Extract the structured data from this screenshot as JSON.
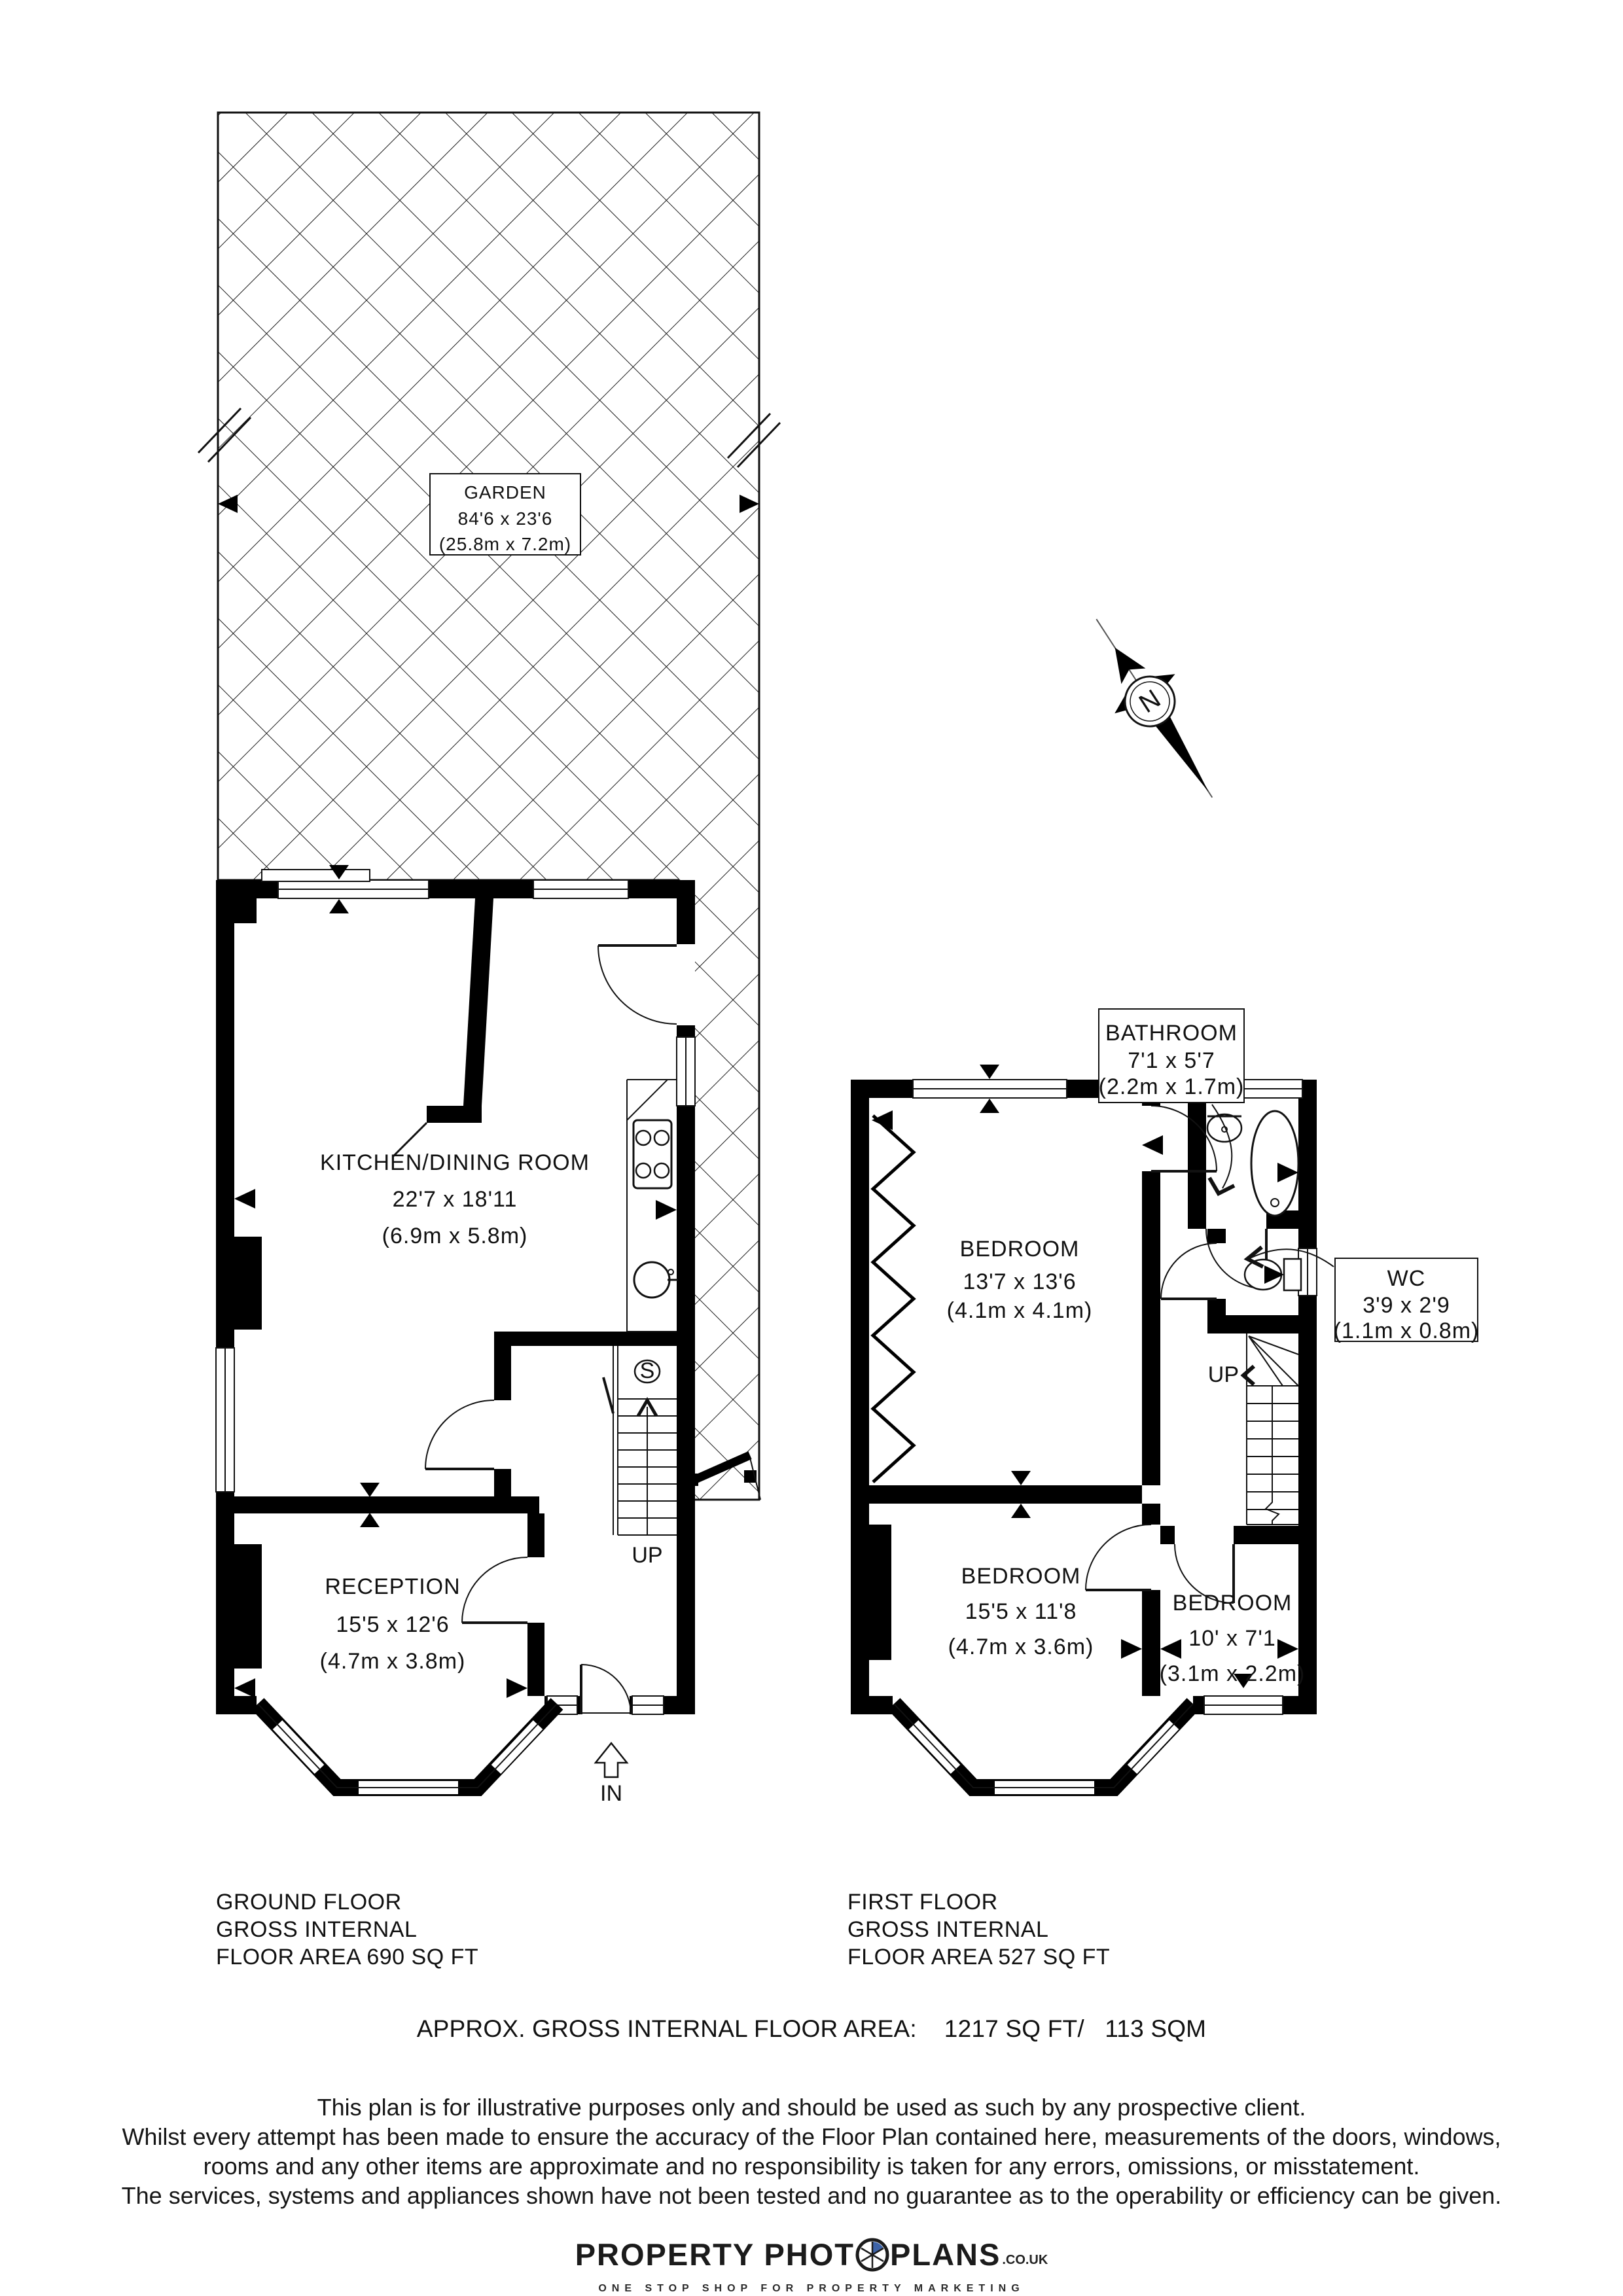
{
  "garden": {
    "name": "GARDEN",
    "size_imperial": "84'6 x 23'6",
    "size_metric": "(25.8m x 7.2m)"
  },
  "ground_floor": {
    "rooms": {
      "kitchen": {
        "name": "KITCHEN/DINING ROOM",
        "size_imperial": "22'7 x 18'11",
        "size_metric": "(6.9m x 5.8m)"
      },
      "reception": {
        "name": "RECEPTION",
        "size_imperial": "15'5 x 12'6",
        "size_metric": "(4.7m x 3.8m)"
      }
    },
    "labels": {
      "up": "UP",
      "in": "IN",
      "storage": "S"
    },
    "summary": {
      "line1": "GROUND FLOOR",
      "line2": "GROSS INTERNAL",
      "line3": "FLOOR AREA 690 SQ FT"
    }
  },
  "first_floor": {
    "rooms": {
      "bathroom": {
        "name": "BATHROOM",
        "size_imperial": "7'1 x 5'7",
        "size_metric": "(2.2m x 1.7m)"
      },
      "wc": {
        "name": "WC",
        "size_imperial": "3'9 x 2'9",
        "size_metric": "(1.1m x 0.8m)"
      },
      "bedroom1": {
        "name": "BEDROOM",
        "size_imperial": "13'7 x 13'6",
        "size_metric": "(4.1m x 4.1m)"
      },
      "bedroom2": {
        "name": "BEDROOM",
        "size_imperial": "15'5 x 11'8",
        "size_metric": "(4.7m x 3.6m)"
      },
      "bedroom3": {
        "name": "BEDROOM",
        "size_imperial": "10' x 7'1",
        "size_metric": "(3.1m x 2.2m)"
      }
    },
    "labels": {
      "up": "UP"
    },
    "summary": {
      "line1": "FIRST FLOOR",
      "line2": "GROSS INTERNAL",
      "line3": "FLOOR AREA 527 SQ FT"
    }
  },
  "compass": {
    "north": "N"
  },
  "footer": {
    "approx_area": "APPROX. GROSS INTERNAL FLOOR AREA:    1217 SQ FT/   113 SQM",
    "disclaimer": [
      "This plan is for illustrative purposes only and should be used as such by any prospective client.",
      "Whilst every attempt has been made to ensure the accuracy of the Floor Plan contained here, measurements of the doors, windows,",
      "rooms and any other items are approximate and no responsibility is taken for any errors, omissions, or misstatement.",
      "The services, systems and appliances shown have not been tested and no guarantee as to the operability or efficiency can be given."
    ],
    "logo": {
      "word1": "PROPERTY PHOT",
      "word2": "PLANS",
      "domain": ".CO.UK",
      "tagline": "ONE STOP SHOP FOR PROPERTY MARKETING"
    }
  },
  "colors": {
    "wall": "#000000",
    "accent_blue": "#3d63a8",
    "paper": "#ffffff"
  }
}
